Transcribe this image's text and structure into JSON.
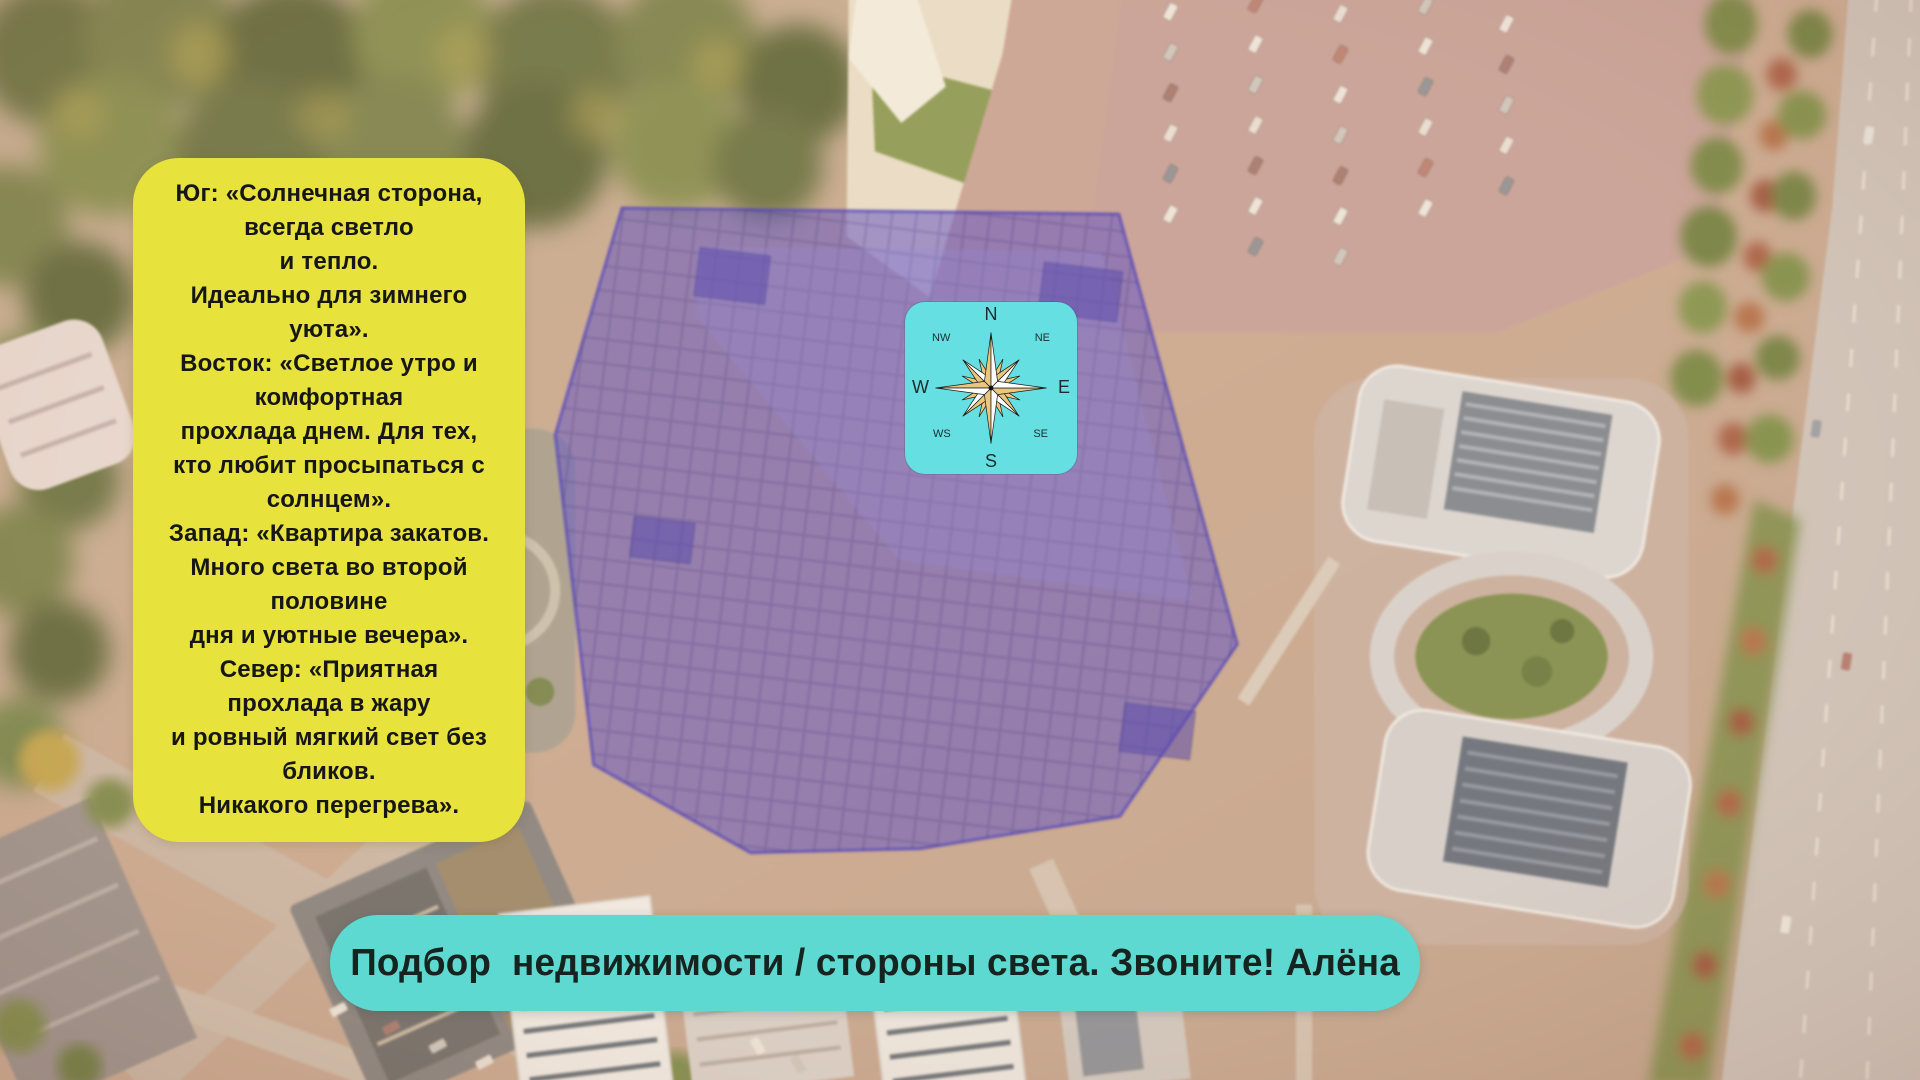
{
  "info_card": {
    "text": "Юг: «Солнечная сторона,\nвсегда светло\nи тепло.\nИдеально для зимнего\nуюта».\nВосток: «Светлое утро и\nкомфортная\nпрохлада днем. Для тех,\nкто любит просыпаться с\nсолнцем».\nЗапад: «Квартира закатов.\nМного света во второй\nполовине\nдня и уютные вечера».\nСевер: «Приятная\nпрохлада в жару\nи ровный мягкий свет без\nбликов.\nНикакого перегрева»."
  },
  "compass": {
    "n": "N",
    "ne": "NE",
    "e": "E",
    "se": "SE",
    "s": "S",
    "ws": "WS",
    "w": "W",
    "nw": "NW"
  },
  "banner": {
    "text": "Подбор  недвижимости / стороны света. Звоните! Алёна"
  },
  "colors": {
    "card_yellow": "#e7e23c",
    "compass_cyan": "#65dfe2",
    "banner_cyan": "#5ed9d2",
    "overlay_purple": "#5748c5",
    "compass_gold": "#eac77d",
    "text_dark": "#161616"
  }
}
